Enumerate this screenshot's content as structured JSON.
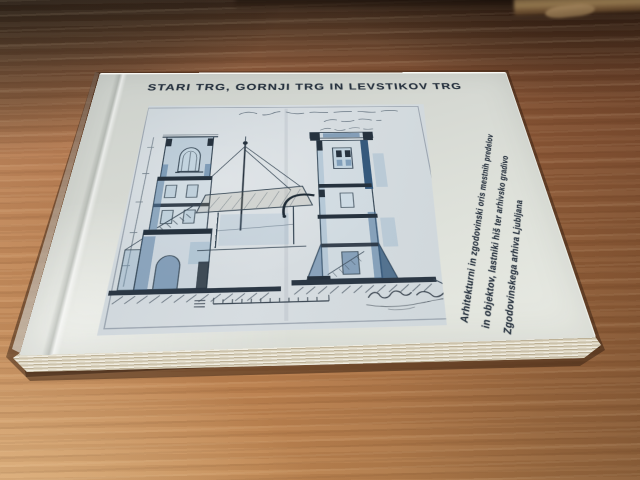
{
  "book_cover": {
    "title": "STARI TRG, GORNJI TRG IN LEVSTIKOV TRG",
    "side_text_lines": [
      "Arhitekturni in zgodovinski oris mestnih predelov",
      "in objektov, lastniki hiš ter arhivsko gradivo",
      "Zgodovinskega arhiva Ljubljana"
    ],
    "text_color": "#26313e",
    "cover_color": "#d9dcd6",
    "drawing_sheet": {
      "paper_color": "#cfd7dc",
      "ink_color": "#3a4a58",
      "wash_blue": "#6f94b5",
      "figures": [
        "left-tower-section-drawing",
        "flagpole-with-guy-wires-drawing",
        "right-tower-section-drawing",
        "handwritten-caption",
        "scale-bar",
        "signature"
      ]
    }
  },
  "environment": {
    "desk_wood_color": "#b27549",
    "desk_shadow_corner_color": "#33241a",
    "furniture_edge_color": "#8a6f4a",
    "page_edge_color": "#e7e1d1",
    "cast_shadow_color": "#54301a"
  }
}
